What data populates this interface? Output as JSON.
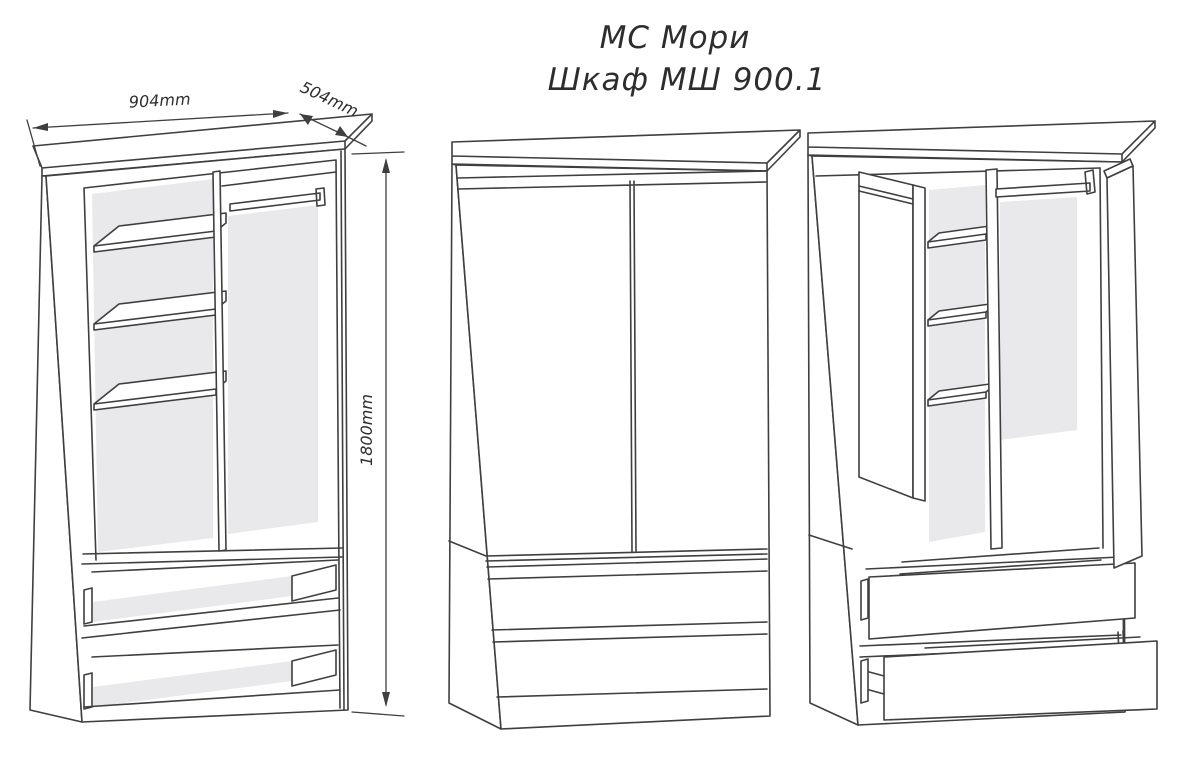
{
  "title": {
    "line1": "МС Мори",
    "line2": "Шкаф МШ 900.1"
  },
  "dimensions": {
    "width": "904mm",
    "depth": "504mm",
    "height": "1800mm"
  },
  "colors": {
    "line": "#3f3f41",
    "panel": "#e9e9eb",
    "background": "#ffffff",
    "text": "#2d2d2f"
  }
}
